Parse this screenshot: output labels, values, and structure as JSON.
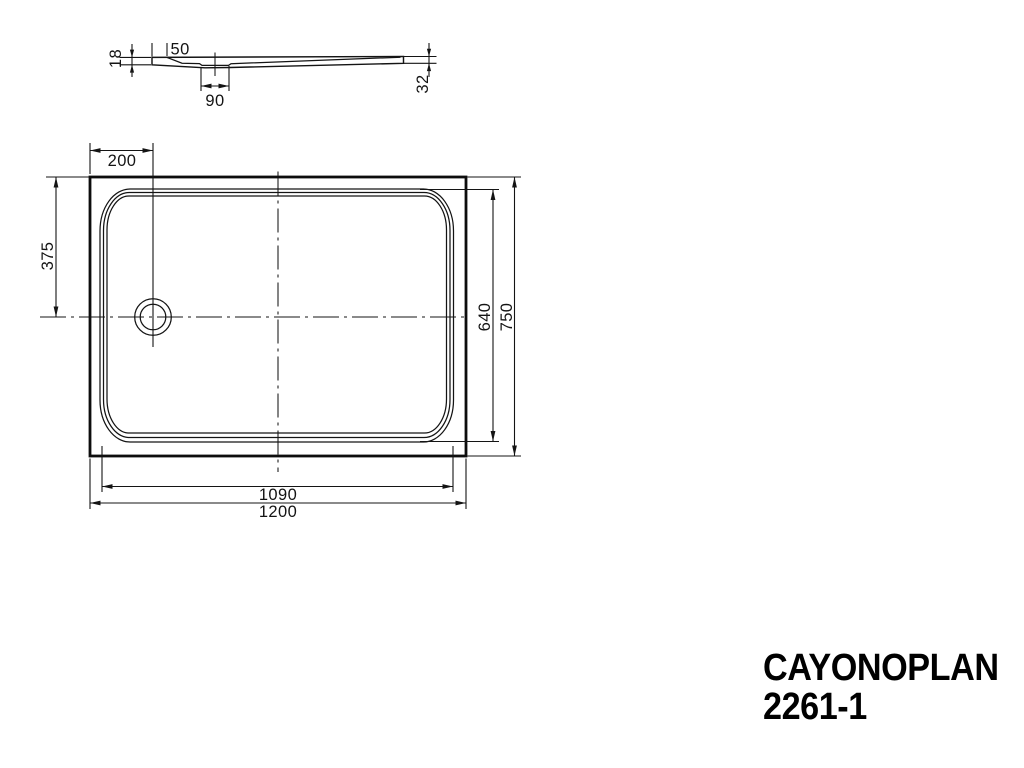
{
  "title": {
    "product_name": "CAYONOPLAN",
    "model_number": "2261-1"
  },
  "section_view": {
    "dim_rim_height": "18",
    "dim_rim_width": "50",
    "dim_drain_recess_width": "90",
    "dim_edge_height": "32"
  },
  "plan_view": {
    "dim_drain_offset_x": "200",
    "dim_drain_offset_y": "375",
    "dim_inner_height": "640",
    "dim_outer_height": "750",
    "dim_inner_length": "1090",
    "dim_outer_length": "1200"
  }
}
